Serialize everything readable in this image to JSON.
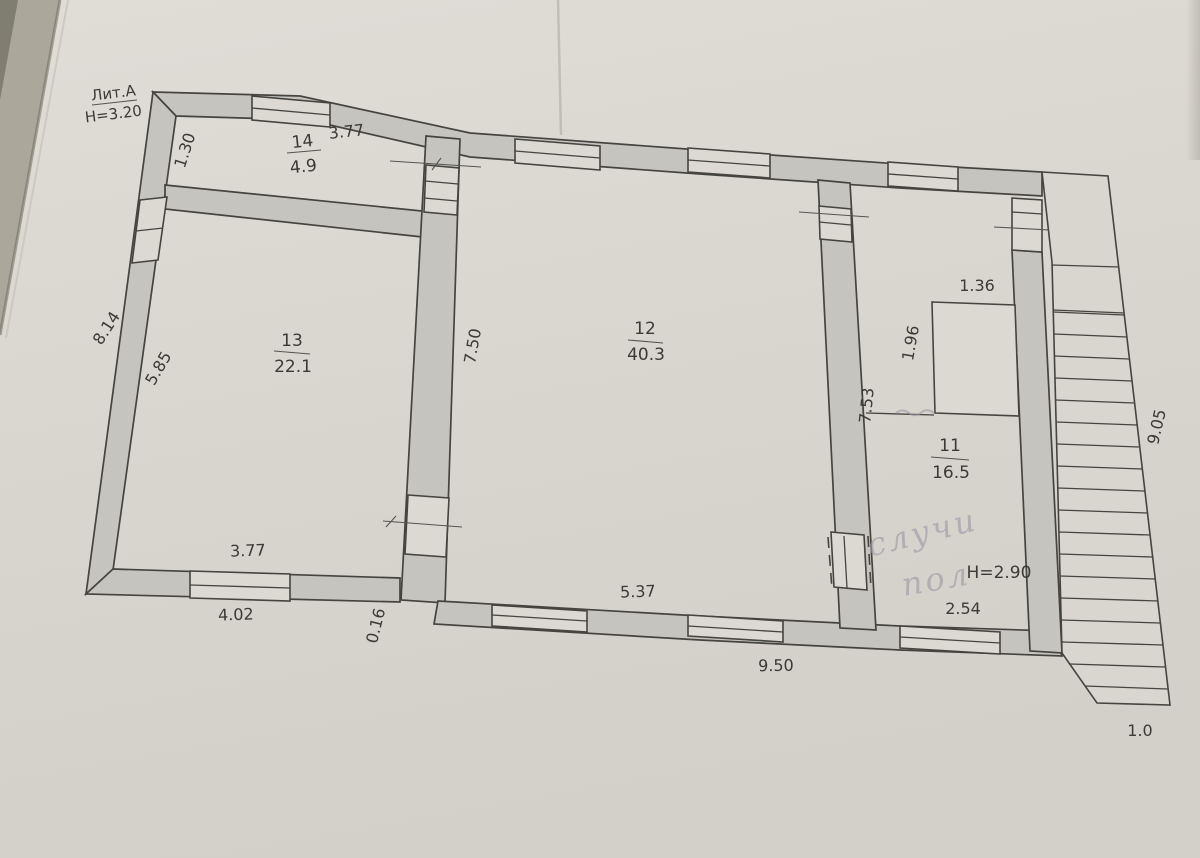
{
  "document": {
    "litera": "Лит.А",
    "building_height": "Н=3.20",
    "secondary_height": "Н=2.90",
    "handwritten_note": {
      "line1": "случи",
      "line2": "пол"
    }
  },
  "rooms": [
    {
      "number": "14",
      "area": "4.9",
      "width_dim": "3.77"
    },
    {
      "number": "13",
      "area": "22.1"
    },
    {
      "number": "12",
      "area": "40.3"
    },
    {
      "number": "11",
      "area": "16.5"
    }
  ],
  "dimensions": {
    "room14_depth": "1.30",
    "left_wall_outer": "8.14",
    "room13_left": "5.85",
    "room12_left": "7.50",
    "shaft_width": "1.36",
    "shaft_depth": "1.96",
    "room11_left": "7.53",
    "stair_outer": "9.05",
    "room13_bottom": "3.77",
    "bottom_left_outer": "4.02",
    "wall_offset": "0.16",
    "room12_bottom": "5.37",
    "bottom_outer": "9.50",
    "room11_bottom": "2.54",
    "stair_width": "1.0"
  },
  "colors": {
    "paper": "#dcd8d2",
    "wall_fill": "#c5c4bf",
    "ink": "#3b3a35",
    "pencil": "#9e99a6",
    "background_surface": "#aba79a"
  }
}
